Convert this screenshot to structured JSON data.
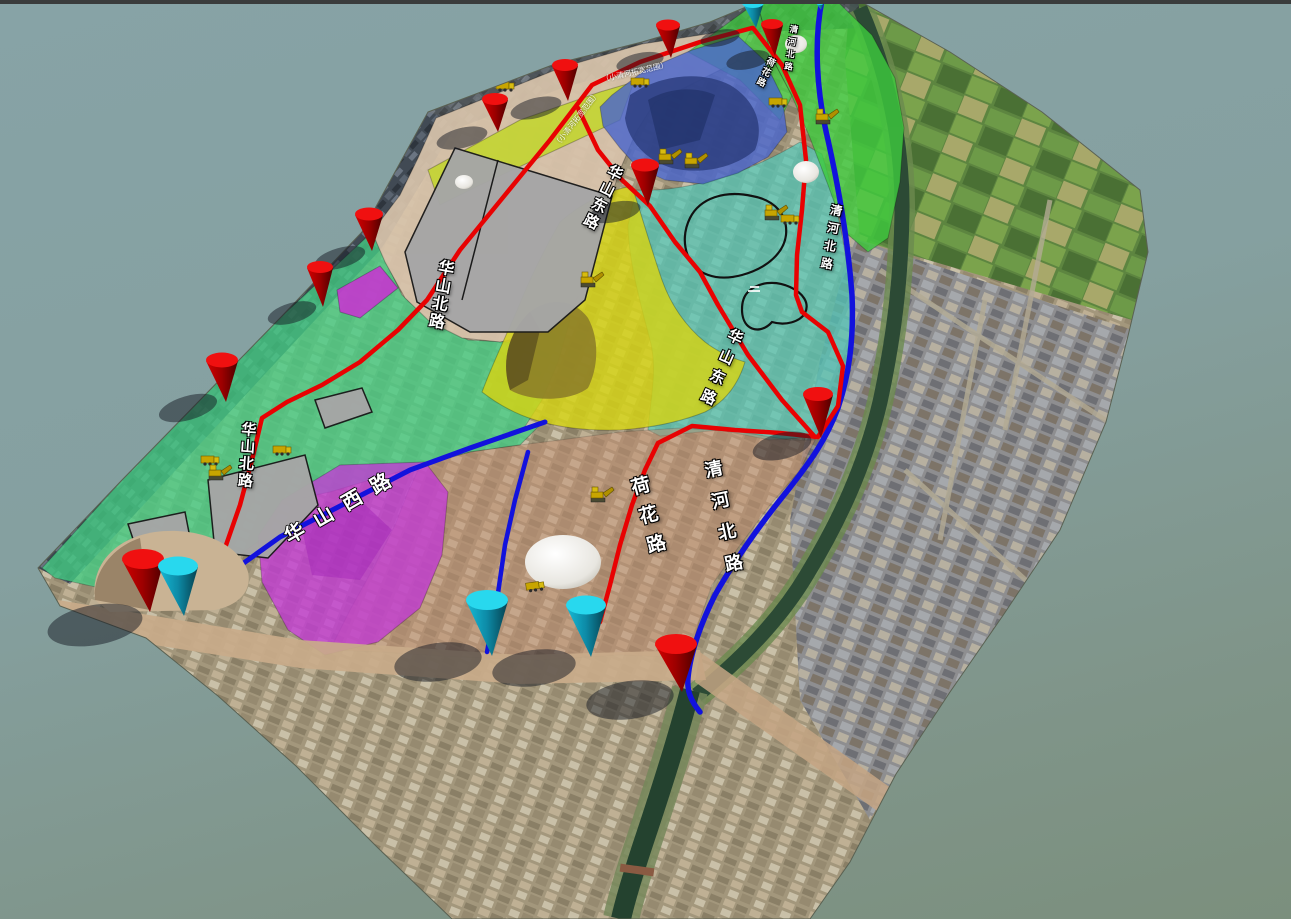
{
  "viewport": {
    "background_top": "#87a3a6",
    "background_bottom": "#7b8f7d",
    "top_bar_color": "#3a3c3c"
  },
  "road_labels": [
    {
      "id": "huashan-north-upper",
      "text": "华山北路"
    },
    {
      "id": "huashan-north-lower",
      "text": "华山北路"
    },
    {
      "id": "huashan-west",
      "text": "华山西路"
    },
    {
      "id": "huashan-east-upper",
      "text": "华山东路"
    },
    {
      "id": "huashan-east-lower",
      "text": "华山东路"
    },
    {
      "id": "hehua-road-north",
      "text": "荷花路"
    },
    {
      "id": "hehua-road-south",
      "text": "荷花路"
    },
    {
      "id": "qinghe-north-top",
      "text": "清河北路"
    },
    {
      "id": "qinghe-north-mid",
      "text": "清河北路"
    },
    {
      "id": "qinghe-north-south",
      "text": "清河北路"
    }
  ],
  "annotations": [
    {
      "id": "riverside-note-1",
      "text": "（小清河拓宽范围）"
    },
    {
      "id": "riverside-note-2",
      "text": "（小清河拓宽范围）"
    }
  ],
  "markers": {
    "red_cone_count": 11,
    "cyan_cone_count": 5,
    "red_cone_color": "#e00000",
    "cyan_cone_color": "#25d6ea"
  },
  "roads": {
    "primary_color": "#e80202",
    "secondary_color": "#1212dd"
  },
  "zones": [
    {
      "name": "beige-staging-zone",
      "color": "#d8c3ab"
    },
    {
      "name": "blue-rock-zone",
      "color": "#4a66cc"
    },
    {
      "name": "green-east-zone",
      "color": "#3ecb3e"
    },
    {
      "name": "teal-center-zone",
      "color": "#52c7b8"
    },
    {
      "name": "yellow-zone",
      "color": "#d6d414"
    },
    {
      "name": "lime-strip-zone",
      "color": "#c3d52e"
    },
    {
      "name": "green-west-zone",
      "color": "#45cd84"
    },
    {
      "name": "magenta-zone",
      "color": "#cc2fd4"
    },
    {
      "name": "brown-south-zone",
      "color": "#c28d70"
    },
    {
      "name": "gray-parcel",
      "color": "#a6a6a6"
    }
  ],
  "vehicles": {
    "count": 14,
    "type": "construction-equipment",
    "color": "#d4b500"
  }
}
